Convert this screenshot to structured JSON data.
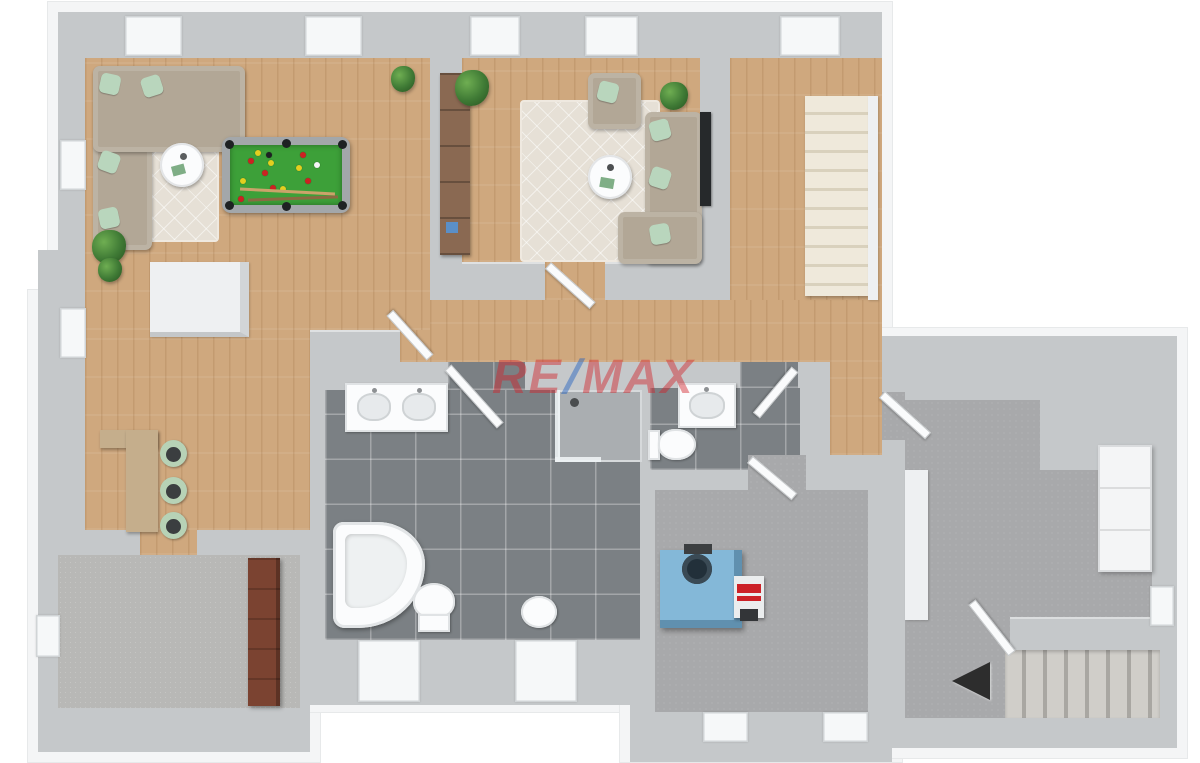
{
  "watermark": {
    "part1": "RE",
    "slash": "/",
    "part2": "MAX"
  },
  "colors": {
    "wall": "#c5c8ca",
    "wall-rim": "#f4f5f6",
    "wall-white": "#eef0f2",
    "wood": "#cfa87e",
    "tile": "#7b8084",
    "concrete": "#a8a9ab",
    "carpet": "#b8b8b6",
    "rug": "#e6e0d6",
    "sofa": "#b2a796",
    "pillow": "#b9d6bd",
    "table-white": "#fbfcfd",
    "wood-furniture": "#8a6952",
    "counter": "#c5ae8c",
    "stool": "#b7d2b6",
    "pool-frame": "#a3a7aa",
    "pool-felt": "#3da039",
    "ball-red": "#cc2222",
    "ball-yellow": "#e3cf1f",
    "boiler": "#84b8d8",
    "wardrobe": "#7b4331",
    "stair-cream": "#efe9db",
    "stair-step-line": "#d9d1bd",
    "stair-concrete": "#d0cec9",
    "tv": "#26292b",
    "plant": "#3f7a35",
    "door": "#fafbfc",
    "window": "#f6f8f9",
    "watermark-red": "#d2232a",
    "watermark-blue": "#1f5fc0"
  }
}
